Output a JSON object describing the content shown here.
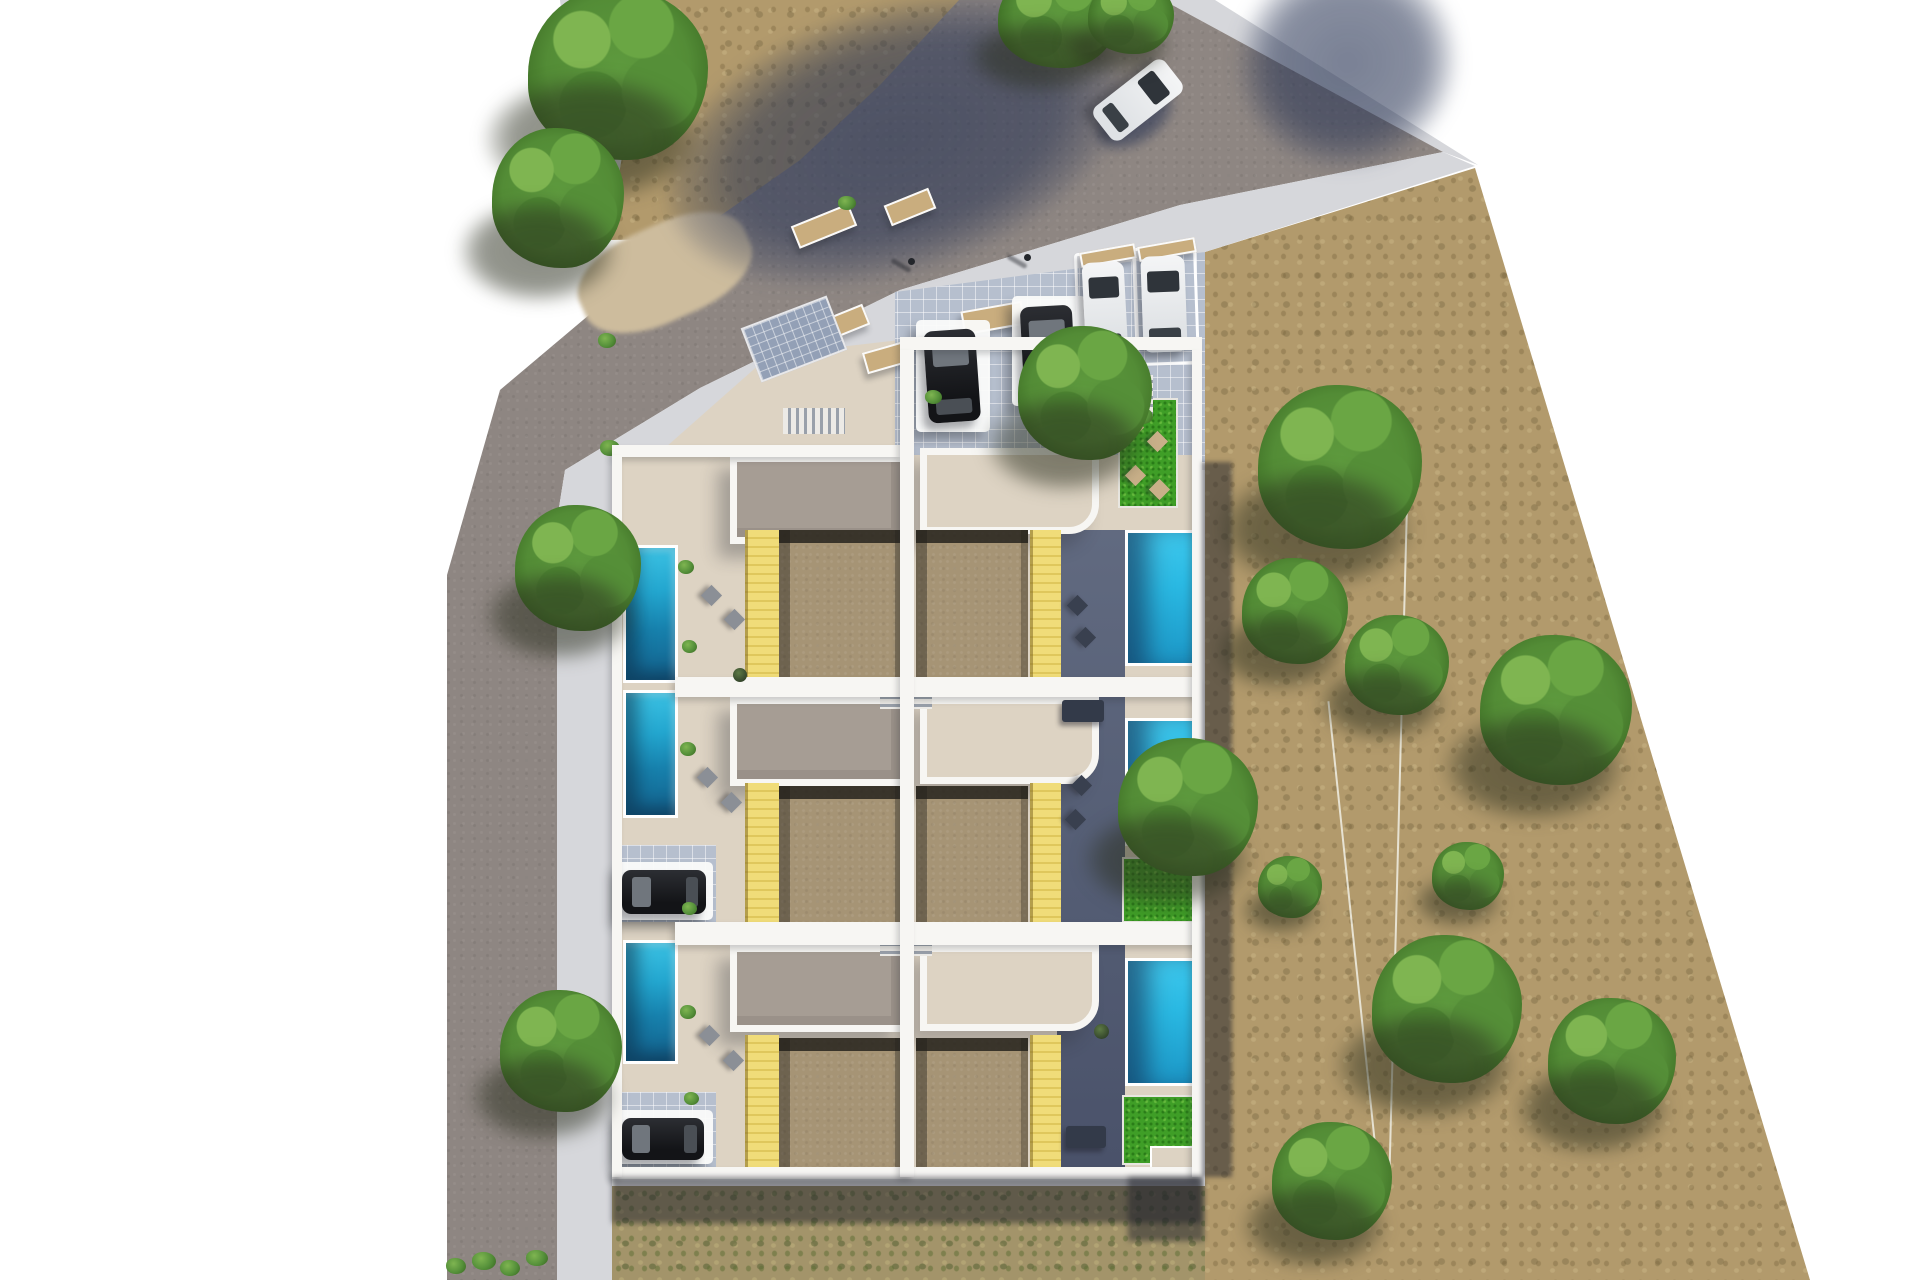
{
  "scene": {
    "description": "Aerial top-down 3D architectural render of a corner-plot residential development: six terraced villas arranged in two mirrored columns of three, each villa with a private swimming pool, yellow timber deck and sand-coloured roof courtyard; an L-shaped grey road with pavements wraps the west and north sides, a tiled entrance plaza with pergola carports and parked cars sits at the north entrance, and a large dry tan scrubland field dotted with trees occupies the east half of the plot.",
    "villas": {
      "rows": 3,
      "columns": 2,
      "total": 6
    },
    "features": {
      "swimming_pools": 6,
      "yellow_timber_decks": 6,
      "sand_roof_courtyards": 6,
      "private_lawns": 5,
      "carports_with_pergolas": 4,
      "parked_dark_cars": 4,
      "parked_white_cars": 2,
      "moving_white_cars_on_road": 1,
      "pedestrians": 2,
      "trees": 16,
      "sun_loungers": 14,
      "garden_sofas": 2,
      "timber_bench_planters": 7,
      "solar_panel_arrays": 1,
      "fence_lines_in_field": 2
    },
    "colors": {
      "css_vars": "--road:#8e8682;--sidewalk:#d6d7db;--plaza:#e4e4e6;--cream:#ddd3c3;--taupe:#a69d94;--tan:#a69475;--yellow:#eed96f;--pool:#2fc0e8;--pool-deep:#135f8a;--slate:#59627a;--lawn:#3f9e27;--wall:#f7f6f3;--field:#b29a6c;--tree:#55903a;--car-dark:#1a1b1e;--car-white:#f0f1f3;--shadow:#242f4e",
      "road_asphalt": "#8e8682",
      "sidewalk": "#d6d7db",
      "building_walls": "#f7f6f3",
      "roof_courtyard_sand": "#a69475",
      "deck_yellow": "#eed96f",
      "pool_water": "#2fc0e8",
      "pool_deep": "#135f8a",
      "shaded_terrace_slate": "#59627a",
      "lawn_green": "#3f9e27",
      "field_grass_tan": "#b29a6c",
      "tree_green": "#55903a",
      "shadow_navy": "#242f4e",
      "background": "#ffffff"
    }
  }
}
